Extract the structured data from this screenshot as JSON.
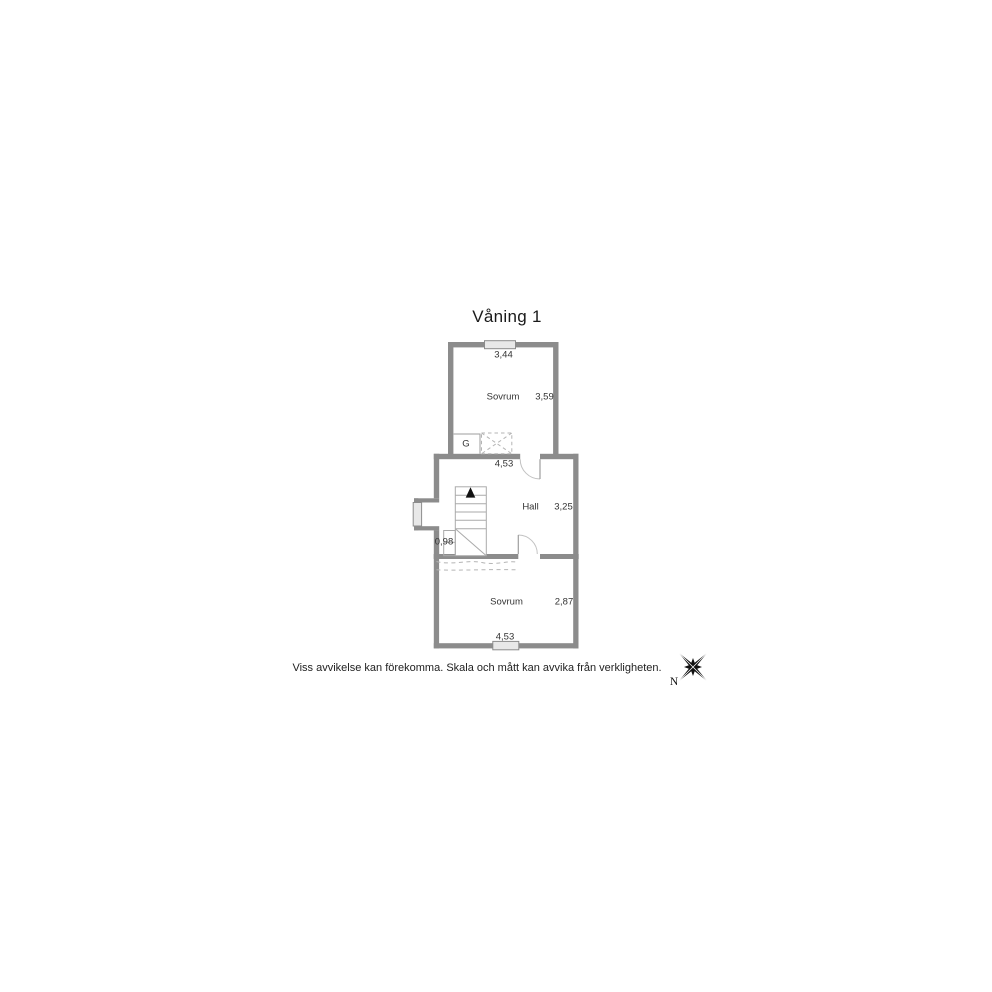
{
  "title": "Våning 1",
  "floor_plan": {
    "rooms": [
      {
        "name": "Sovrum",
        "width_label": "3,44",
        "height_label": "3,59"
      },
      {
        "name": "Hall",
        "width_label": "4,53",
        "height_label": "3,25"
      },
      {
        "name": "Sovrum",
        "width_label": "4,53",
        "height_label": "2,87"
      }
    ],
    "closet_label": "G",
    "stair_width_label": "0,98"
  },
  "disclaimer": "Viss avvikelse kan förekomma. Skala och mått kan avvika från verkligheten.",
  "compass": {
    "north_label": "N"
  },
  "colors": {
    "wall": "#8c8c8c",
    "window_fill": "#e8e8e8",
    "thin_line": "#9e9e9e",
    "stair_line": "#aaaaaa",
    "dashed_line": "#b5b5b5",
    "door_arc": "#c2c2c2",
    "text": "#333333"
  }
}
